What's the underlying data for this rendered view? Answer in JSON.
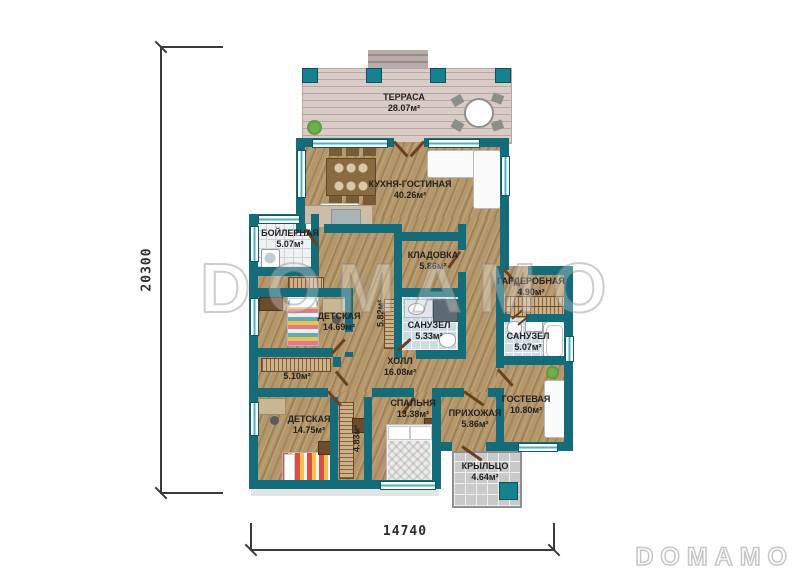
{
  "rooms": [
    {
      "name": "ТЕРРАСА",
      "area": "28.07м²"
    },
    {
      "name": "КУХНЯ-ГОСТИНАЯ",
      "area": "40.26м²"
    },
    {
      "name": "БОЙЛЕРНАЯ",
      "area": "5.07м²"
    },
    {
      "name": "КЛАДОВКА",
      "area": "5.86м²"
    },
    {
      "name": "ДЕТСКАЯ",
      "area": "14.69м²"
    },
    {
      "name": "САНУЗЕЛ",
      "area": "5.33м²"
    },
    {
      "name": "ГАРДЕРОБНАЯ",
      "area": "4.90м²"
    },
    {
      "name": "САНУЗЕЛ",
      "area": "5.07м²"
    },
    {
      "name": "ХОЛЛ",
      "area": "16.08м²"
    },
    {
      "name": "",
      "area": "5.10м²"
    },
    {
      "name": "ДЕТСКАЯ",
      "area": "14.75м²"
    },
    {
      "name": "СПАЛЬНЯ",
      "area": "13.38м²"
    },
    {
      "name": "ПРИХОЖАЯ",
      "area": "5.86м²"
    },
    {
      "name": "ГОСТЕВАЯ",
      "area": "10.80м²"
    },
    {
      "name": "КРЫЛЬЦО",
      "area": "4.64м²"
    },
    {
      "name": "",
      "area": "5.82м²"
    },
    {
      "name": "",
      "area": "4.83м²"
    }
  ],
  "dimensions": {
    "vertical": "20300",
    "horizontal": "14740"
  },
  "watermark": {
    "center": "DOMAMO",
    "logo": "DOMAMO"
  },
  "colors": {
    "wall": "#146b79",
    "wood_floor": "#b4976b",
    "terrace_floor": "#d9cbc6",
    "bath_tile": "#ccdbe4",
    "porch_tile": "#c9c9c9",
    "door": "#6b4020"
  }
}
